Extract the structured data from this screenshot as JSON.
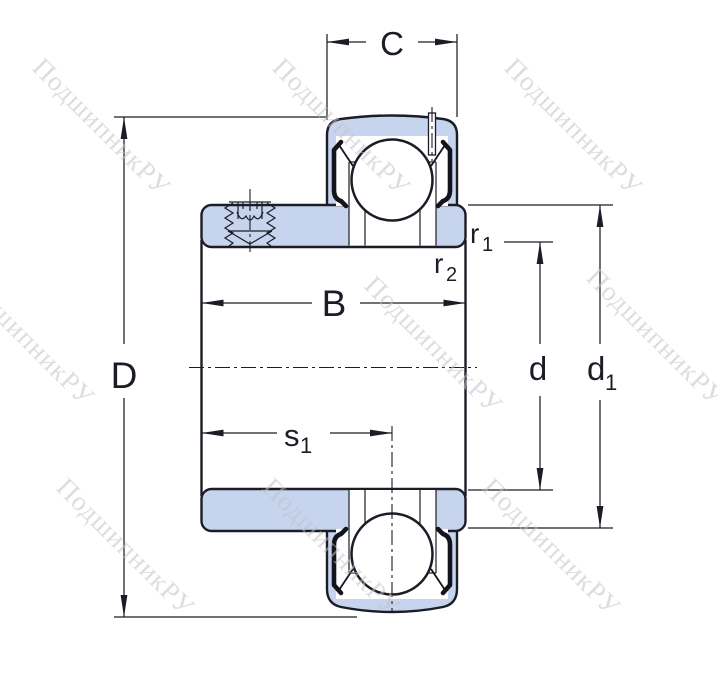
{
  "diagram": {
    "labels": {
      "C": "C",
      "D": "D",
      "B": "B",
      "d": "d",
      "d1": {
        "base": "d",
        "sub": "1"
      },
      "r1": {
        "base": "r",
        "sub": "1"
      },
      "r2": {
        "base": "r",
        "sub": "2"
      },
      "s1": {
        "base": "s",
        "sub": "1"
      }
    },
    "watermark": {
      "text": "ПодшипникРУ"
    },
    "colors": {
      "line": "#1c1c26",
      "fill": "#c6d4ed",
      "wm": "#c2c2c6"
    }
  }
}
